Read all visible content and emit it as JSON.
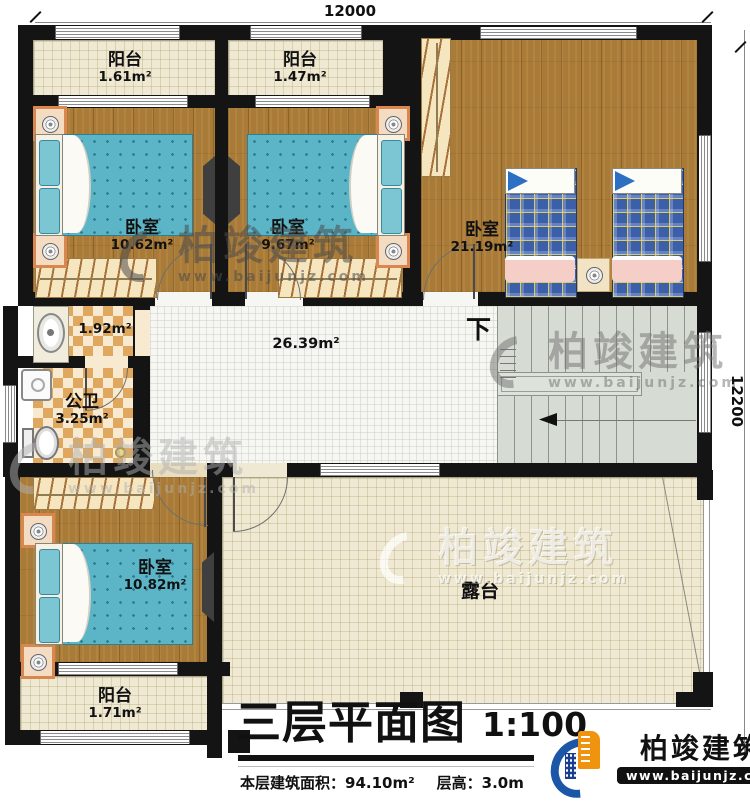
{
  "meta": {
    "title": "三层平面图",
    "scale": "1:100",
    "area_line": "本层建筑面积：94.10m²",
    "height_line": "层高：3.0m"
  },
  "dims": {
    "width": "12000",
    "depth": "12200"
  },
  "stairs": {
    "down": "下"
  },
  "rooms": [
    {
      "label": "阳台",
      "area": "1.61m²"
    },
    {
      "label": "阳台",
      "area": "1.47m²"
    },
    {
      "label": "卧室",
      "area": "10.62m²"
    },
    {
      "label": "卧室",
      "area": "9.67m²"
    },
    {
      "label": "卧室",
      "area": "21.19m²"
    },
    {
      "label": "",
      "area": "1.92m²"
    },
    {
      "label": "公卫",
      "area": "3.25m²"
    },
    {
      "label": "",
      "area": "26.39m²"
    },
    {
      "label": "卧室",
      "area": "10.82m²"
    },
    {
      "label": "阳台",
      "area": "1.71m²"
    },
    {
      "label": "露台",
      "area": ""
    }
  ],
  "brand": {
    "name": "柏竣建筑",
    "site": "www.baijunjz.com"
  },
  "colors": {
    "wall": "#141414",
    "wood_floor": "#a87b38",
    "balcony_floor": "#efe9d4",
    "hall_floor": "#f6f6f2",
    "stair_floor": "#d6dcd3",
    "bath_checker": "#dfa85e",
    "bed_blue": "#5cb5c7",
    "plaid_blue": "#3c5fa9",
    "nightstand_orange": "#d9874f",
    "logo_blue": "#1c57a7",
    "logo_orange": "#f0930f"
  }
}
